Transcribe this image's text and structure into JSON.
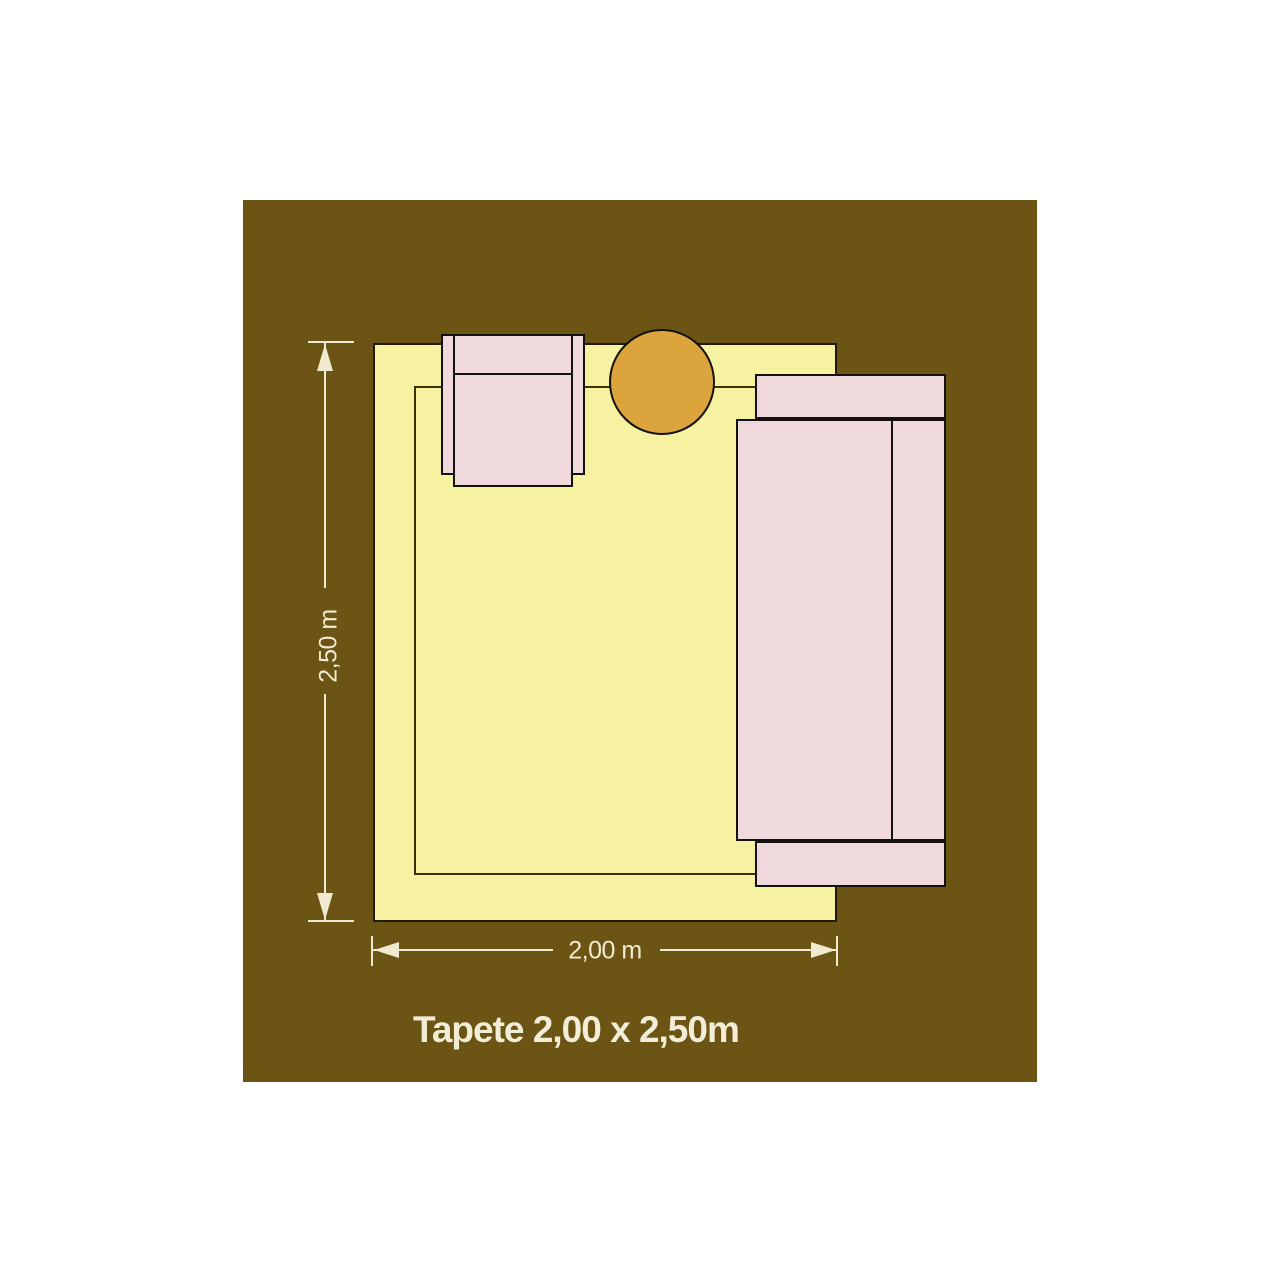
{
  "diagram": {
    "caption": "Tapete 2,00 x 2,50m",
    "dimensions": {
      "height_label": "2,50 m",
      "width_label": "2,00 m"
    },
    "objects": {
      "floor": "floor-area",
      "rug": "rug",
      "armchair": "armchair",
      "side_table": "round-side-table",
      "sofa": "sofa"
    },
    "colors": {
      "canvas": "#FFFFFF",
      "floor": "#6B5414",
      "rug": "#F6F2A2",
      "rug_outline": "#211A06",
      "rug_inner_line": "#3A300A",
      "furniture_fill": "#F0D9DD",
      "furniture_outline": "#141210",
      "side_table": "#DCA43C",
      "dimension_lines": "#F0EBD0",
      "caption_text": "#F2EDD6"
    }
  }
}
